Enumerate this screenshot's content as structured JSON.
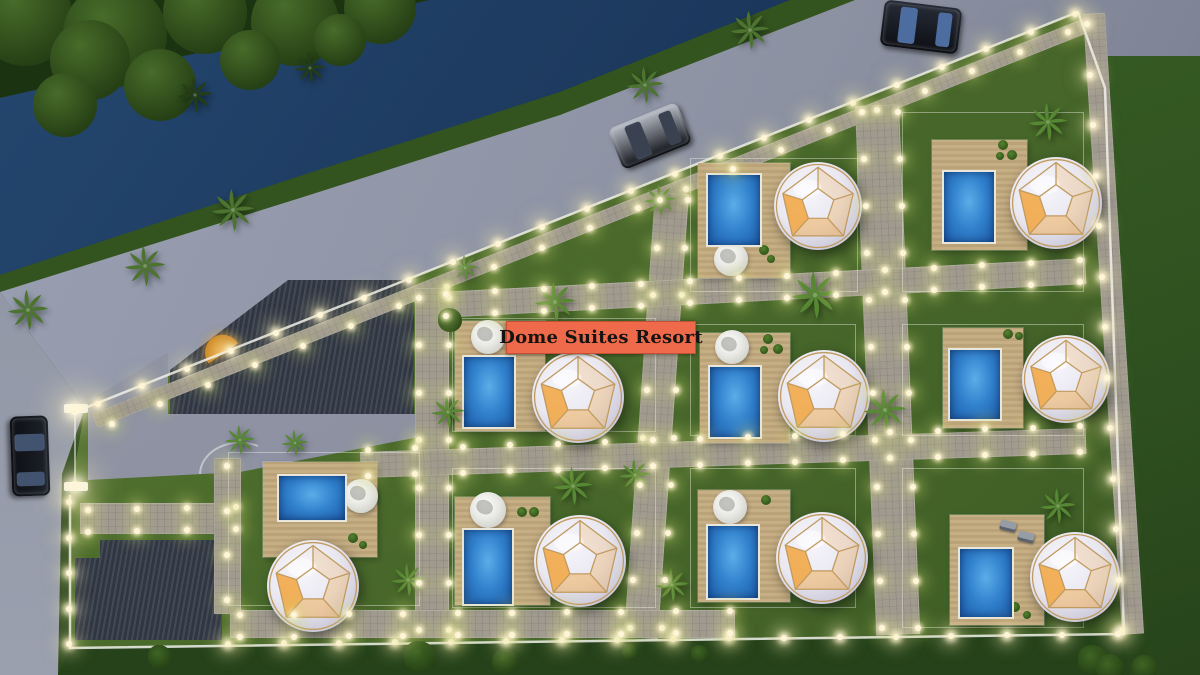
{
  "meta": {
    "description": "Dusk aerial 3D architectural rendering of a glamping resort site plan: geodesic dome villas with private pools and wooden decks inside a light-lined walled compound, bordered by a tree-lined canal and road with parked cars."
  },
  "label": {
    "text": "Dome Suites Resort"
  },
  "colors": {
    "label_bg": "#ee6a4b",
    "label_fg": "#161412",
    "pool_water": "#3181cd",
    "deck_wood": "#c6ae85",
    "grass_resort": "#4c6c2c",
    "grass_outside": "#2b471d",
    "canal_water": "#1c3a5e",
    "road_asphalt": "#8c92a2",
    "dome_shell": "#e9e7f0",
    "dome_frame": "#c09a5e",
    "dome_glow": "#f2a43e",
    "building_roof": "#39404d",
    "path_paving": "#a09a90",
    "light_warm": "#fff6d9"
  },
  "site": {
    "dome_suite_count": 9,
    "pool_count": 9,
    "car_count": 3,
    "building_count": 2
  },
  "units": [
    {
      "name": "dome-suite-1",
      "fence": [
        690,
        158,
        166,
        132
      ],
      "deck": [
        698,
        163,
        92,
        115
      ],
      "pool": [
        706,
        173,
        52,
        70
      ],
      "daybed": [
        731,
        259,
        17
      ],
      "dome": [
        818,
        206,
        44
      ],
      "pots": [
        [
          764,
          250,
          5
        ],
        [
          771,
          259,
          4
        ]
      ]
    },
    {
      "name": "dome-suite-2",
      "fence": [
        902,
        112,
        180,
        178
      ],
      "deck": [
        932,
        140,
        95,
        110
      ],
      "pool": [
        942,
        170,
        50,
        70
      ],
      "daybed": null,
      "dome": [
        1056,
        203,
        46
      ],
      "pots": [
        [
          1003,
          145,
          5
        ],
        [
          1000,
          156,
          4
        ],
        [
          1012,
          155,
          5
        ]
      ]
    },
    {
      "name": "dome-suite-3",
      "fence": [
        452,
        318,
        202,
        112
      ],
      "deck": [
        455,
        321,
        90,
        110
      ],
      "pool": [
        462,
        355,
        50,
        70
      ],
      "daybed": [
        488,
        337,
        17
      ],
      "dome": [
        578,
        397,
        46
      ],
      "pots": [
        [
          522,
          348,
          5
        ],
        [
          534,
          348,
          4
        ]
      ]
    },
    {
      "name": "dome-suite-4",
      "fence": [
        690,
        324,
        164,
        110
      ],
      "deck": [
        700,
        333,
        90,
        110
      ],
      "pool": [
        708,
        365,
        50,
        70
      ],
      "daybed": [
        732,
        347,
        17
      ],
      "dome": [
        824,
        396,
        46
      ],
      "pots": [
        [
          768,
          339,
          5
        ],
        [
          764,
          350,
          4
        ],
        [
          778,
          349,
          5
        ]
      ]
    },
    {
      "name": "dome-suite-5",
      "fence": [
        902,
        324,
        180,
        110
      ],
      "deck": [
        943,
        328,
        80,
        100
      ],
      "pool": [
        948,
        348,
        50,
        69
      ],
      "daybed": null,
      "dome": [
        1066,
        379,
        44
      ],
      "pots": [
        [
          1008,
          334,
          5
        ],
        [
          1019,
          336,
          4
        ]
      ]
    },
    {
      "name": "dome-suite-6",
      "fence": [
        228,
        452,
        190,
        152
      ],
      "deck": [
        263,
        462,
        114,
        95
      ],
      "pool": [
        277,
        474,
        66,
        44
      ],
      "daybed": [
        361,
        496,
        17
      ],
      "dome": [
        313,
        586,
        46
      ],
      "pots": [
        [
          353,
          538,
          5
        ],
        [
          363,
          545,
          4
        ]
      ]
    },
    {
      "name": "dome-suite-7",
      "fence": [
        452,
        468,
        202,
        138
      ],
      "deck": [
        455,
        497,
        95,
        108
      ],
      "pool": [
        462,
        528,
        48,
        74
      ],
      "daybed": [
        488,
        510,
        18
      ],
      "dome": [
        580,
        561,
        46
      ],
      "pots": [
        [
          522,
          512,
          5
        ],
        [
          534,
          512,
          5
        ]
      ]
    },
    {
      "name": "dome-suite-8",
      "fence": [
        690,
        468,
        164,
        138
      ],
      "deck": [
        698,
        490,
        92,
        112
      ],
      "pool": [
        706,
        524,
        50,
        72
      ],
      "daybed": [
        730,
        507,
        17
      ],
      "dome": [
        822,
        558,
        46
      ],
      "pots": [
        [
          766,
          500,
          5
        ]
      ]
    },
    {
      "name": "dome-suite-9",
      "fence": [
        902,
        468,
        180,
        158
      ],
      "deck": [
        950,
        515,
        94,
        110
      ],
      "pool": [
        958,
        547,
        52,
        68
      ],
      "daybed": null,
      "chairs": [
        [
          1000,
          521
        ],
        [
          1018,
          532
        ]
      ],
      "dome": [
        1075,
        577,
        45
      ],
      "pots": [
        [
          1015,
          607,
          5
        ],
        [
          1027,
          615,
          4
        ]
      ]
    }
  ],
  "cars": [
    {
      "name": "car-dark-sedan-top",
      "x": 882,
      "y": 4,
      "w": 78,
      "h": 46,
      "angle": 7,
      "body": "#262b36",
      "glass": "#4d6da0"
    },
    {
      "name": "car-silver-sedan",
      "x": 613,
      "y": 114,
      "w": 74,
      "h": 44,
      "angle": -22,
      "body": "#b7bdc7",
      "glass": "#3a4252"
    },
    {
      "name": "car-dark-sedan-side",
      "x": -10,
      "y": 437,
      "w": 80,
      "h": 38,
      "angle": 88,
      "body": "#1d2129",
      "glass": "#41536e"
    }
  ],
  "vegetation": {
    "canopy": [
      [
        25,
        18,
        48
      ],
      [
        115,
        35,
        52
      ],
      [
        205,
        12,
        42
      ],
      [
        295,
        22,
        44
      ],
      [
        380,
        8,
        36
      ],
      [
        90,
        60,
        40
      ],
      [
        160,
        85,
        36
      ],
      [
        65,
        105,
        32
      ],
      [
        250,
        60,
        30
      ],
      [
        340,
        40,
        26
      ]
    ],
    "palms": [
      {
        "x": 28,
        "y": 310,
        "s": 46,
        "tone": "road"
      },
      {
        "x": 145,
        "y": 266,
        "s": 46,
        "tone": "road"
      },
      {
        "x": 233,
        "y": 210,
        "s": 48,
        "tone": "road"
      },
      {
        "x": 645,
        "y": 85,
        "s": 42,
        "tone": "road"
      },
      {
        "x": 750,
        "y": 30,
        "s": 44,
        "tone": "road"
      },
      {
        "x": 195,
        "y": 95,
        "s": 40,
        "tone": "dark"
      },
      {
        "x": 310,
        "y": 68,
        "s": 36,
        "tone": "dark"
      },
      {
        "x": 555,
        "y": 302,
        "s": 46,
        "tone": "bright"
      },
      {
        "x": 815,
        "y": 295,
        "s": 54,
        "tone": "bright"
      },
      {
        "x": 885,
        "y": 410,
        "s": 48,
        "tone": "bright"
      },
      {
        "x": 573,
        "y": 486,
        "s": 44,
        "tone": "bright"
      },
      {
        "x": 1048,
        "y": 122,
        "s": 44,
        "tone": "bright"
      },
      {
        "x": 660,
        "y": 200,
        "s": 36,
        "tone": "bright"
      },
      {
        "x": 465,
        "y": 268,
        "s": 30,
        "tone": "bright"
      },
      {
        "x": 240,
        "y": 440,
        "s": 34,
        "tone": "bright"
      },
      {
        "x": 295,
        "y": 443,
        "s": 30,
        "tone": "bright"
      },
      {
        "x": 408,
        "y": 580,
        "s": 38,
        "tone": "bright"
      },
      {
        "x": 672,
        "y": 585,
        "s": 38,
        "tone": "bright"
      },
      {
        "x": 1058,
        "y": 506,
        "s": 40,
        "tone": "bright"
      },
      {
        "x": 635,
        "y": 475,
        "s": 36,
        "tone": "bright"
      },
      {
        "x": 448,
        "y": 412,
        "s": 38,
        "tone": "bright"
      }
    ],
    "bushes": [
      [
        420,
        657,
        16
      ],
      [
        505,
        662,
        13
      ],
      [
        1093,
        660,
        15
      ],
      [
        160,
        657,
        12
      ],
      [
        1145,
        668,
        13
      ],
      [
        1110,
        668,
        14
      ],
      [
        700,
        654,
        9
      ],
      [
        630,
        652,
        8
      ],
      [
        450,
        320,
        12
      ]
    ]
  },
  "light_strips": [
    {
      "x1": 98,
      "y1": 404,
      "x2": 1075,
      "y2": 14,
      "n": 23,
      "k": "wall"
    },
    {
      "x1": 112,
      "y1": 424,
      "x2": 1068,
      "y2": 32,
      "n": 21,
      "k": ""
    },
    {
      "x1": 1087,
      "y1": 24,
      "x2": 1122,
      "y2": 630,
      "n": 13,
      "k": "wall"
    },
    {
      "x1": 228,
      "y1": 644,
      "x2": 1118,
      "y2": 634,
      "n": 17,
      "k": "wall"
    },
    {
      "x1": 69,
      "y1": 502,
      "x2": 69,
      "y2": 644,
      "n": 5,
      "k": "wall"
    },
    {
      "x1": 419,
      "y1": 298,
      "x2": 419,
      "y2": 630,
      "n": 8,
      "k": ""
    },
    {
      "x1": 449,
      "y1": 298,
      "x2": 449,
      "y2": 630,
      "n": 8,
      "k": ""
    },
    {
      "x1": 660,
      "y1": 200,
      "x2": 630,
      "y2": 628,
      "n": 10,
      "k": ""
    },
    {
      "x1": 688,
      "y1": 200,
      "x2": 662,
      "y2": 628,
      "n": 10,
      "k": ""
    },
    {
      "x1": 862,
      "y1": 112,
      "x2": 882,
      "y2": 628,
      "n": 12,
      "k": ""
    },
    {
      "x1": 898,
      "y1": 112,
      "x2": 918,
      "y2": 628,
      "n": 12,
      "k": ""
    },
    {
      "x1": 446,
      "y1": 294,
      "x2": 1080,
      "y2": 260,
      "n": 14,
      "k": ""
    },
    {
      "x1": 446,
      "y1": 316,
      "x2": 1080,
      "y2": 282,
      "n": 14,
      "k": ""
    },
    {
      "x1": 368,
      "y1": 450,
      "x2": 1080,
      "y2": 426,
      "n": 16,
      "k": ""
    },
    {
      "x1": 368,
      "y1": 476,
      "x2": 1080,
      "y2": 452,
      "n": 16,
      "k": ""
    },
    {
      "x1": 240,
      "y1": 615,
      "x2": 730,
      "y2": 611,
      "n": 10,
      "k": ""
    },
    {
      "x1": 240,
      "y1": 637,
      "x2": 730,
      "y2": 633,
      "n": 10,
      "k": ""
    },
    {
      "x1": 88,
      "y1": 510,
      "x2": 236,
      "y2": 507,
      "n": 4,
      "k": ""
    },
    {
      "x1": 88,
      "y1": 532,
      "x2": 236,
      "y2": 529,
      "n": 4,
      "k": ""
    },
    {
      "x1": 227,
      "y1": 466,
      "x2": 227,
      "y2": 600,
      "n": 4,
      "k": ""
    },
    {
      "x1": 75,
      "y1": 410,
      "x2": 75,
      "y2": 486,
      "n": 2,
      "k": "gate"
    }
  ]
}
